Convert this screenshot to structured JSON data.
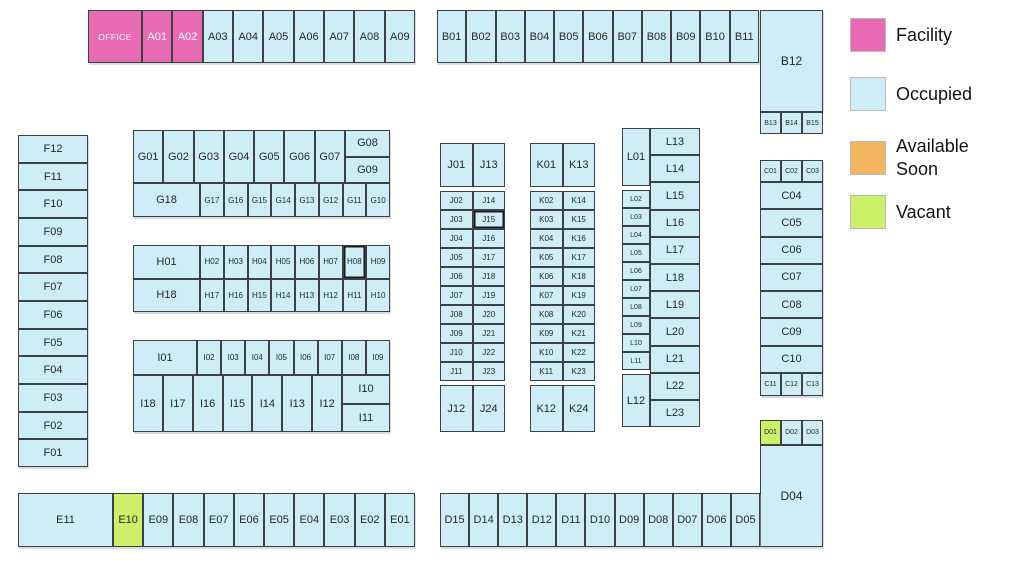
{
  "legend": {
    "items": [
      {
        "label": "Facility",
        "status": "facility",
        "color": "#e76ab2"
      },
      {
        "label": "Occupied",
        "status": "occupied",
        "color": "#cfedf6"
      },
      {
        "label": "Available Soon",
        "status": "available",
        "color": "#f2b45c"
      },
      {
        "label": "Vacant",
        "status": "vacant",
        "color": "#cbf168"
      }
    ]
  },
  "blocks": {
    "office": {
      "label": "OFFICE",
      "status": "facility"
    },
    "a": [
      {
        "label": "A01",
        "status": "facility"
      },
      {
        "label": "A02",
        "status": "facility"
      },
      {
        "label": "A03"
      },
      {
        "label": "A04"
      },
      {
        "label": "A05"
      },
      {
        "label": "A06"
      },
      {
        "label": "A07"
      },
      {
        "label": "A08"
      },
      {
        "label": "A09"
      }
    ],
    "b": [
      {
        "label": "B01"
      },
      {
        "label": "B02"
      },
      {
        "label": "B03"
      },
      {
        "label": "B04"
      },
      {
        "label": "B05"
      },
      {
        "label": "B06"
      },
      {
        "label": "B07"
      },
      {
        "label": "B08"
      },
      {
        "label": "B09"
      },
      {
        "label": "B10"
      },
      {
        "label": "B11"
      }
    ],
    "b12": {
      "label": "B12"
    },
    "b_small": [
      {
        "label": "B13"
      },
      {
        "label": "B14"
      },
      {
        "label": "B15"
      }
    ],
    "f": [
      {
        "label": "F12"
      },
      {
        "label": "F11"
      },
      {
        "label": "F10"
      },
      {
        "label": "F09"
      },
      {
        "label": "F08"
      },
      {
        "label": "F07"
      },
      {
        "label": "F06"
      },
      {
        "label": "F05"
      },
      {
        "label": "F04"
      },
      {
        "label": "F03"
      },
      {
        "label": "F02"
      },
      {
        "label": "F01"
      }
    ],
    "g_top": [
      {
        "label": "G01"
      },
      {
        "label": "G02"
      },
      {
        "label": "G03"
      },
      {
        "label": "G04"
      },
      {
        "label": "G05"
      },
      {
        "label": "G06"
      },
      {
        "label": "G07"
      }
    ],
    "g08": {
      "label": "G08"
    },
    "g09": {
      "label": "G09"
    },
    "g18": {
      "label": "G18"
    },
    "g_bottom": [
      {
        "label": "G17"
      },
      {
        "label": "G16"
      },
      {
        "label": "G15"
      },
      {
        "label": "G14"
      },
      {
        "label": "G13"
      },
      {
        "label": "G12"
      },
      {
        "label": "G11"
      },
      {
        "label": "G10"
      }
    ],
    "h01": {
      "label": "H01"
    },
    "h_row1": [
      {
        "label": "H02"
      },
      {
        "label": "H03"
      },
      {
        "label": "H04"
      },
      {
        "label": "H05"
      },
      {
        "label": "H06"
      },
      {
        "label": "H07"
      },
      {
        "label": "H08",
        "selected": true
      },
      {
        "label": "H09"
      }
    ],
    "h18": {
      "label": "H18"
    },
    "h_row2": [
      {
        "label": "H17"
      },
      {
        "label": "H16"
      },
      {
        "label": "H15"
      },
      {
        "label": "H14"
      },
      {
        "label": "H13"
      },
      {
        "label": "H12"
      },
      {
        "label": "H11"
      },
      {
        "label": "H10"
      }
    ],
    "i01": {
      "label": "I01"
    },
    "i_top": [
      {
        "label": "I02"
      },
      {
        "label": "I03"
      },
      {
        "label": "I04"
      },
      {
        "label": "I05"
      },
      {
        "label": "I06"
      },
      {
        "label": "I07"
      },
      {
        "label": "I08"
      },
      {
        "label": "I09"
      }
    ],
    "i_bottom": [
      {
        "label": "I18"
      },
      {
        "label": "I17"
      },
      {
        "label": "I16"
      },
      {
        "label": "I15"
      },
      {
        "label": "I14"
      },
      {
        "label": "I13"
      },
      {
        "label": "I12"
      }
    ],
    "i10": {
      "label": "I10"
    },
    "i11": {
      "label": "I11"
    },
    "j01": {
      "label": "J01"
    },
    "j_left": [
      {
        "label": "J02"
      },
      {
        "label": "J03"
      },
      {
        "label": "J04"
      },
      {
        "label": "J05"
      },
      {
        "label": "J06"
      },
      {
        "label": "J07"
      },
      {
        "label": "J08"
      },
      {
        "label": "J09"
      },
      {
        "label": "J10"
      },
      {
        "label": "J11"
      }
    ],
    "j12": {
      "label": "J12"
    },
    "j13": {
      "label": "J13"
    },
    "j_right": [
      {
        "label": "J14"
      },
      {
        "label": "J15",
        "selected": true
      },
      {
        "label": "J16"
      },
      {
        "label": "J17"
      },
      {
        "label": "J18"
      },
      {
        "label": "J19"
      },
      {
        "label": "J20"
      },
      {
        "label": "J21"
      },
      {
        "label": "J22"
      },
      {
        "label": "J23"
      }
    ],
    "j24": {
      "label": "J24"
    },
    "k01": {
      "label": "K01"
    },
    "k_left": [
      {
        "label": "K02"
      },
      {
        "label": "K03"
      },
      {
        "label": "K04"
      },
      {
        "label": "K05"
      },
      {
        "label": "K06"
      },
      {
        "label": "K07"
      },
      {
        "label": "K08"
      },
      {
        "label": "K09"
      },
      {
        "label": "K10"
      },
      {
        "label": "K11"
      }
    ],
    "k12": {
      "label": "K12"
    },
    "k13": {
      "label": "K13"
    },
    "k_right": [
      {
        "label": "K14"
      },
      {
        "label": "K15"
      },
      {
        "label": "K16"
      },
      {
        "label": "K17"
      },
      {
        "label": "K18"
      },
      {
        "label": "K19"
      },
      {
        "label": "K20"
      },
      {
        "label": "K21"
      },
      {
        "label": "K22"
      },
      {
        "label": "K23"
      }
    ],
    "k24": {
      "label": "K24"
    },
    "l01": {
      "label": "L01"
    },
    "l_left": [
      {
        "label": "L02"
      },
      {
        "label": "L03"
      },
      {
        "label": "L04"
      },
      {
        "label": "L05"
      },
      {
        "label": "L06"
      },
      {
        "label": "L07"
      },
      {
        "label": "L08"
      },
      {
        "label": "L09"
      },
      {
        "label": "L10"
      },
      {
        "label": "L11"
      }
    ],
    "l12": {
      "label": "L12"
    },
    "l_right": [
      {
        "label": "L13"
      },
      {
        "label": "L14"
      },
      {
        "label": "L15"
      },
      {
        "label": "L16"
      },
      {
        "label": "L17"
      },
      {
        "label": "L18"
      },
      {
        "label": "L19"
      },
      {
        "label": "L20"
      },
      {
        "label": "L21"
      },
      {
        "label": "L22"
      },
      {
        "label": "L23"
      }
    ],
    "c_top": [
      {
        "label": "C01"
      },
      {
        "label": "C02"
      },
      {
        "label": "C03"
      }
    ],
    "c_mid": [
      {
        "label": "C04"
      },
      {
        "label": "C05"
      },
      {
        "label": "C06"
      },
      {
        "label": "C07"
      },
      {
        "label": "C08"
      },
      {
        "label": "C09"
      },
      {
        "label": "C10"
      }
    ],
    "c_bottom": [
      {
        "label": "C11"
      },
      {
        "label": "C12"
      },
      {
        "label": "C13"
      }
    ],
    "d_top": [
      {
        "label": "D01",
        "status": "vacant"
      },
      {
        "label": "D02"
      },
      {
        "label": "D03"
      }
    ],
    "d04": {
      "label": "D04"
    },
    "d_row": [
      {
        "label": "D15"
      },
      {
        "label": "D14"
      },
      {
        "label": "D13"
      },
      {
        "label": "D12"
      },
      {
        "label": "D11"
      },
      {
        "label": "D10"
      },
      {
        "label": "D09"
      },
      {
        "label": "D08"
      },
      {
        "label": "D07"
      },
      {
        "label": "D06"
      },
      {
        "label": "D05"
      }
    ],
    "e11": {
      "label": "E11"
    },
    "e_row": [
      {
        "label": "E10",
        "status": "vacant"
      },
      {
        "label": "E09"
      },
      {
        "label": "E08"
      },
      {
        "label": "E07"
      },
      {
        "label": "E06"
      },
      {
        "label": "E05"
      },
      {
        "label": "E04"
      },
      {
        "label": "E03"
      },
      {
        "label": "E02"
      },
      {
        "label": "E01"
      }
    ]
  }
}
